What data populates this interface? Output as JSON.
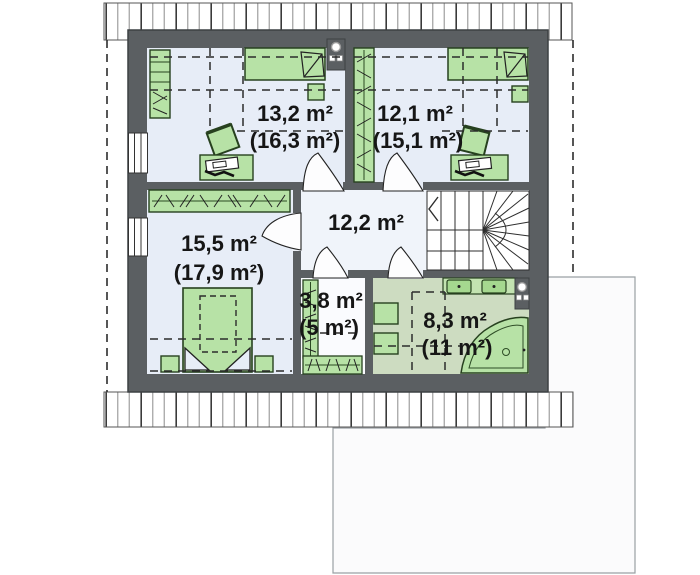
{
  "plan": {
    "type": "floor-plan",
    "level": "attic-floor",
    "rooms": [
      {
        "key": "bedroom-top-left",
        "area": "13,2 m²",
        "area_total": "(16,3 m²)"
      },
      {
        "key": "bedroom-top-right",
        "area": "12,1 m²",
        "area_total": "(15,1 m²)"
      },
      {
        "key": "hall",
        "area": "12,2 m²",
        "area_total": ""
      },
      {
        "key": "bedroom-bottom-left",
        "area": "15,5 m²",
        "area_total": "(17,9 m²)"
      },
      {
        "key": "wardrobe-room",
        "area": "3,8 m²",
        "area_total": "(5 m²)"
      },
      {
        "key": "bathroom",
        "area": "8,3 m²",
        "area_total": "(11 m²)"
      }
    ],
    "colors": {
      "wall": "#5b5f62",
      "room_floor": "#e7edf7",
      "hall_floor": "#f0f4fa",
      "wardrobe_floor": "#fafbfe",
      "bathroom_floor": "#cddcc1",
      "furniture_green": "#b7e2a6",
      "furniture_green_dark": "#a5d88f",
      "outline": "#2e2e2e"
    }
  }
}
